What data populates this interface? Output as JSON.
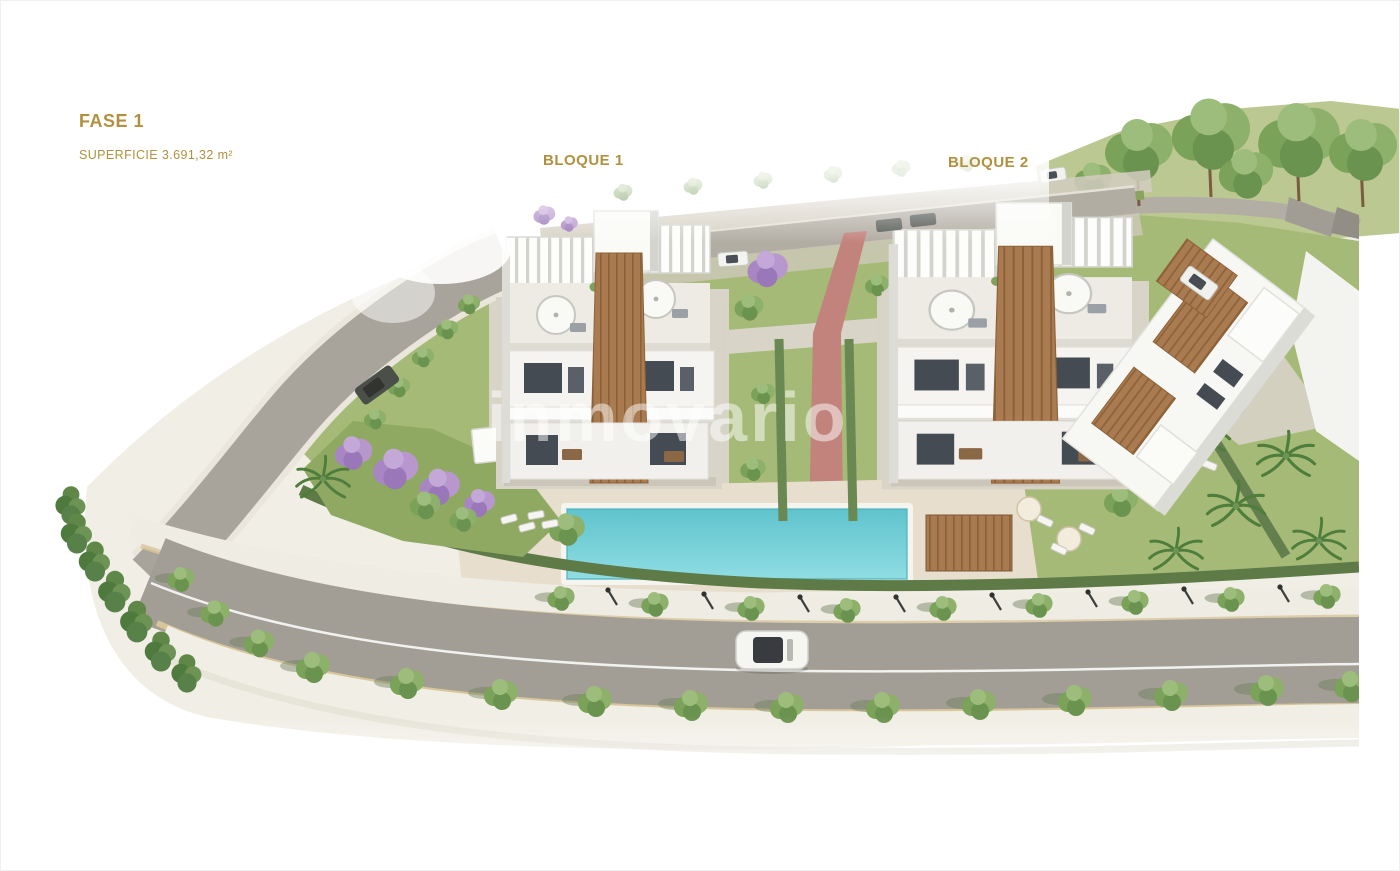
{
  "labels": {
    "phase": "FASE 1",
    "surface": "SUPERFICIE 3.691,32 m²",
    "block1": "BLOQUE 1",
    "block2": "BLOQUE 2"
  },
  "watermark": "inmovario",
  "scene": {
    "type": "3d-aerial-site-plan-render",
    "objects": [
      "apartment-block-1",
      "apartment-block-2",
      "partial-building-right",
      "swimming-pool",
      "perimeter-road",
      "street-trees",
      "jacaranda-trees",
      "palm-trees",
      "red-pedestrian-path",
      "white-car-on-road",
      "parked-cars",
      "roof-pergolas",
      "parasols",
      "sun-loungers",
      "hedges",
      "lawns"
    ]
  },
  "colors": {
    "accent_gold": "#b1913f",
    "pool_water": "#74ccd4",
    "lawn": "#a6ba77",
    "road": "#a9a49b",
    "sidewalk": "#f1eee6",
    "path_red": "#c2837c",
    "hedge": "#5d7a47",
    "wood": "#aa7b50",
    "jacaranda": "#b897cf"
  }
}
